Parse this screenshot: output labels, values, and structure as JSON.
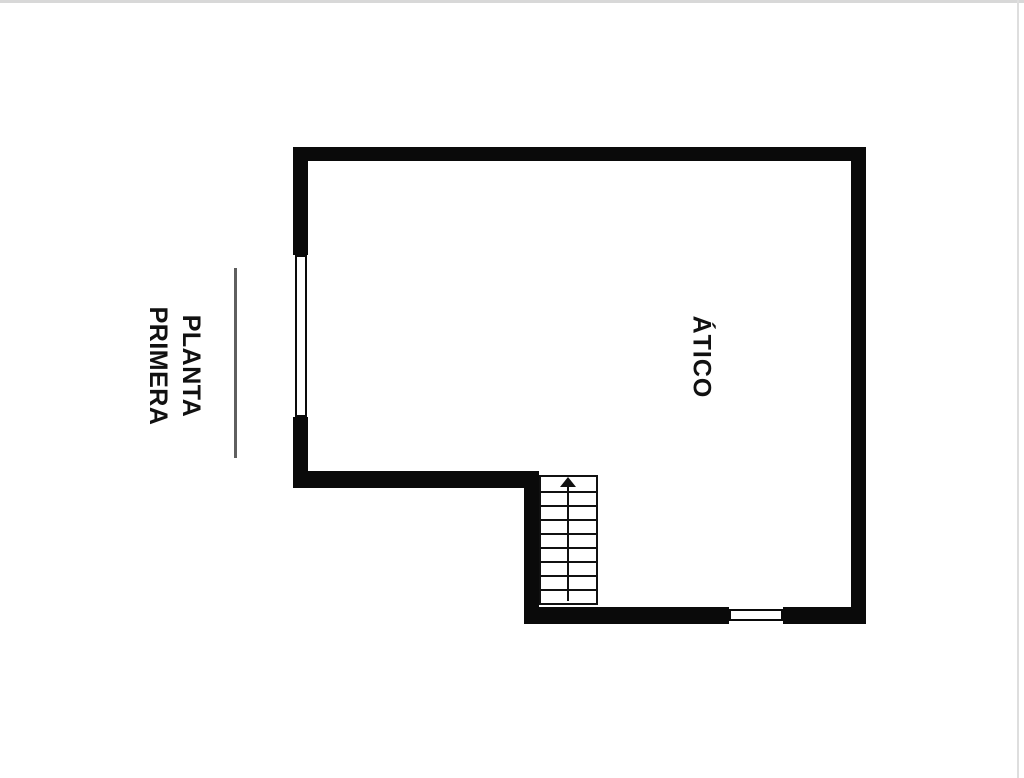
{
  "page": {
    "background_color": "#ffffff",
    "frame_line_color": "#d8d8d8"
  },
  "plan": {
    "title_label": {
      "line1": "PLANTA",
      "line2": "PRIMERA"
    },
    "room_label": "ÁTICO",
    "wall_color": "#0a0a0a",
    "divider_color": "#5f5f5f",
    "stairs": {
      "tread_count": 9,
      "direction": "up"
    }
  }
}
